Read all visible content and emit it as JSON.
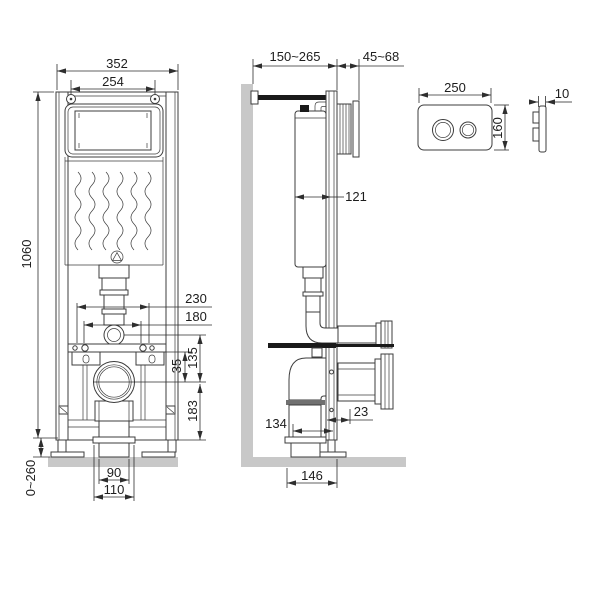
{
  "drawing": {
    "background": "#ffffff",
    "colors": {
      "line": "#3c3c3c",
      "masonry_fill": "#c8c8c8",
      "solid_black": "#1a1a1a"
    },
    "front_view": {
      "logo_icon": "triangle-in-circle-logo",
      "dims": {
        "overall_width": "352",
        "hanger_bolt_spacing": "254",
        "frame_height": "1060",
        "fixing_spacing_outer": "230",
        "fixing_spacing_inner": "180",
        "rail_to_outlet": "35",
        "flush_to_outlet": "135",
        "outlet_to_base": "183",
        "foot_adjustment": "0~260",
        "outlet_bore": "90",
        "outlet_diameter": "110"
      }
    },
    "side_view": {
      "dims": {
        "wall_offset_range": "150~265",
        "front_offset_range": "45~68",
        "cistern_depth": "121",
        "frame_to_flange": "23",
        "outlet_offset": "134",
        "base_depth": "146"
      }
    },
    "flush_plate": {
      "dims": {
        "width": "250",
        "height": "160",
        "thickness": "10"
      }
    }
  }
}
